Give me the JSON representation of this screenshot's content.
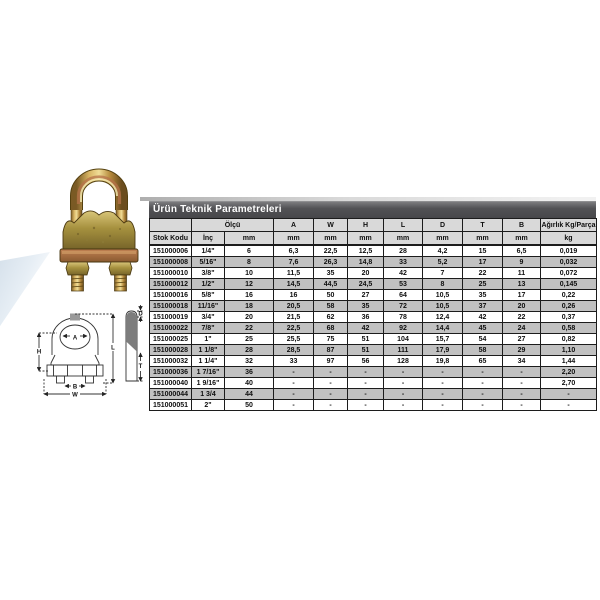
{
  "page": {
    "background": "#ffffff"
  },
  "graphics": {
    "photo_alt": "wire-rope-clip-product-photo",
    "drawing_alt": "wire-rope-clip-dimension-drawing"
  },
  "drawing": {
    "labels": {
      "a": "A",
      "h": "H",
      "l": "L",
      "b": "B",
      "w": "W",
      "d": "D",
      "t": "T"
    }
  },
  "table": {
    "title": "Ürün Teknik Parametreleri",
    "header": {
      "stok_kodu": "Stok Kodu",
      "olcu": "Ölçü",
      "inc": "İnç",
      "mm": "mm",
      "dims": [
        "A",
        "W",
        "H",
        "L",
        "D",
        "T",
        "B"
      ],
      "weight": "Ağırlık Kg/Parça",
      "kg": "kg"
    },
    "rows": [
      [
        "151000006",
        "1/4\"",
        "6",
        "6,3",
        "22,5",
        "12,5",
        "28",
        "4,2",
        "15",
        "6,5",
        "0,019"
      ],
      [
        "151000008",
        "5/16\"",
        "8",
        "7,6",
        "26,3",
        "14,8",
        "33",
        "5,2",
        "17",
        "9",
        "0,032"
      ],
      [
        "151000010",
        "3/8\"",
        "10",
        "11,5",
        "35",
        "20",
        "42",
        "7",
        "22",
        "11",
        "0,072"
      ],
      [
        "151000012",
        "1/2\"",
        "12",
        "14,5",
        "44,5",
        "24,5",
        "53",
        "8",
        "25",
        "13",
        "0,145"
      ],
      [
        "151000016",
        "5/8\"",
        "16",
        "16",
        "50",
        "27",
        "64",
        "10,5",
        "35",
        "17",
        "0,22"
      ],
      [
        "151000018",
        "11/16\"",
        "18",
        "20,5",
        "58",
        "35",
        "72",
        "10,5",
        "37",
        "20",
        "0,26"
      ],
      [
        "151000019",
        "3/4\"",
        "20",
        "21,5",
        "62",
        "36",
        "78",
        "12,4",
        "42",
        "22",
        "0,37"
      ],
      [
        "151000022",
        "7/8\"",
        "22",
        "22,5",
        "68",
        "42",
        "92",
        "14,4",
        "45",
        "24",
        "0,58"
      ],
      [
        "151000025",
        "1\"",
        "25",
        "25,5",
        "75",
        "51",
        "104",
        "15,7",
        "54",
        "27",
        "0,82"
      ],
      [
        "151000028",
        "1 1/8\"",
        "28",
        "28,5",
        "87",
        "51",
        "111",
        "17,9",
        "58",
        "29",
        "1,10"
      ],
      [
        "151000032",
        "1 1/4\"",
        "32",
        "33",
        "97",
        "56",
        "128",
        "19,8",
        "65",
        "34",
        "1,44"
      ],
      [
        "151000036",
        "1 7/16\"",
        "36",
        "-",
        "-",
        "-",
        "-",
        "-",
        "-",
        "-",
        "2,20"
      ],
      [
        "151000040",
        "1 9/16\"",
        "40",
        "-",
        "-",
        "-",
        "-",
        "-",
        "-",
        "-",
        "2,70"
      ],
      [
        "151000044",
        "1 3/4",
        "44",
        "-",
        "-",
        "-",
        "-",
        "-",
        "-",
        "-",
        "-"
      ],
      [
        "151000051",
        "2\"",
        "50",
        "-",
        "-",
        "-",
        "-",
        "-",
        "-",
        "-",
        "-"
      ]
    ]
  },
  "colors": {
    "title_bar": "#4c4c4f",
    "header_bg": "#d9d9d9",
    "row_alt": "#c1c1c1",
    "border": "#1c1c1c",
    "brass": "#c8a14e",
    "copper": "#a8683f"
  }
}
